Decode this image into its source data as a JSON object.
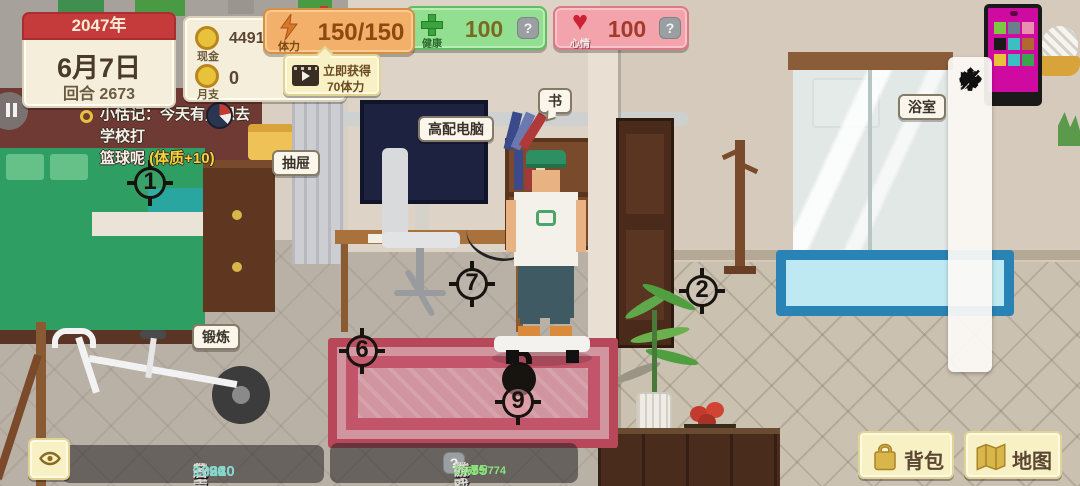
{
  "date_panel": {
    "year": "2047年",
    "date": "6月7日",
    "round": "回合 2673"
  },
  "currency": {
    "cash_label": "现金",
    "cash_value": "449106804",
    "monthly_label": "月支",
    "monthly_value": "0",
    "help_label": "?"
  },
  "stamina": {
    "label": "体力",
    "value": "150/150"
  },
  "stamina_ad": {
    "line1": "立即获得",
    "line2": "70体力"
  },
  "health": {
    "label": "健康",
    "value": "100",
    "help_label": "?"
  },
  "mood": {
    "label": "心情",
    "value": "100",
    "help_label": "?",
    "heart_glyph": "♥"
  },
  "notification": {
    "line1": "小恬记：今天有点想去学校打",
    "line2": "篮球呢 ",
    "bonus": "(体质+10)"
  },
  "object_labels": {
    "drawer": "抽屉",
    "computer": "高配电脑",
    "book": "书",
    "bathroom": "浴室",
    "exercise": "锻炼"
  },
  "markers": {
    "m1": "1",
    "m2": "2",
    "m6": "6",
    "m7": "7",
    "m9": "9"
  },
  "toolbar": {
    "play_glyph": "▶",
    "zoom_in_glyph": "+",
    "zoom_out_glyph": "−",
    "close_glyph": "×"
  },
  "stats_left": {
    "items": [
      {
        "label": "体质",
        "value": "1190"
      },
      {
        "label": "想象",
        "value": "16210"
      },
      {
        "label": "脑力",
        "value": "93340"
      },
      {
        "label": "魅力",
        "value": "50"
      },
      {
        "label": "名声",
        "value": "1662"
      }
    ]
  },
  "stats_right": {
    "items": [
      {
        "label": "美术",
        "value": "2875"
      },
      {
        "label": "行政",
        "value": "12"
      },
      {
        "label": "农才",
        "value": "365"
      },
      {
        "label": "游戏",
        "value": "25609/774"
      }
    ],
    "help_label": "?"
  },
  "actions": {
    "backpack": "背包",
    "map": "地图"
  },
  "colors": {
    "stamina_panel": "#f2b06a",
    "health_panel": "#92df92",
    "mood_panel": "#f2a3ab",
    "accent_cream": "#f8f1c6",
    "value_teal": "#86d8cc",
    "value_green": "#8ae47c",
    "date_header_red": "#c53b3b",
    "marker_black": "#17130e"
  }
}
